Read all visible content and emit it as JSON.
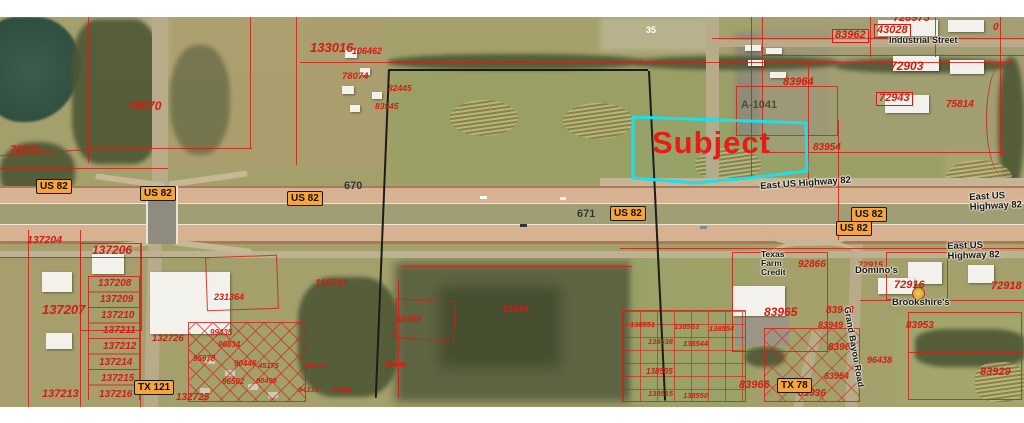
{
  "map": {
    "subject": {
      "label": "Subject"
    },
    "colors": {
      "parcel_line": "#cf2116",
      "parcel_text": "#d21d12",
      "subject_outline": "#1ae0ea",
      "subject_text": "#ea1a14",
      "shield_fill": "#f7a43a",
      "field": "#a3a06b"
    },
    "labels": [
      {
        "kind": "subject",
        "text": "Subject",
        "x": 652,
        "y": 126,
        "fs": 31
      },
      {
        "kind": "parcel",
        "text": "78061",
        "x": 10,
        "y": 145,
        "fs": 11
      },
      {
        "kind": "parcel",
        "text": "78070",
        "x": 128,
        "y": 100,
        "fs": 12
      },
      {
        "kind": "parcel",
        "text": "133016",
        "x": 310,
        "y": 41,
        "fs": 13
      },
      {
        "kind": "parcel",
        "text": "106462",
        "x": 352,
        "y": 47,
        "fs": 9
      },
      {
        "kind": "parcel",
        "text": "78074",
        "x": 342,
        "y": 72,
        "fs": 9.5
      },
      {
        "kind": "parcel",
        "text": "82445",
        "x": 388,
        "y": 84,
        "fs": 8.5
      },
      {
        "kind": "parcel",
        "text": "83545",
        "x": 375,
        "y": 102,
        "fs": 8.5
      },
      {
        "kind": "parcel",
        "text": "728975",
        "x": 893,
        "y": 13,
        "fs": 11
      },
      {
        "kind": "parcel",
        "text": "0",
        "x": 993,
        "y": 23,
        "fs": 10
      },
      {
        "kind": "parcel",
        "text": "83962",
        "x": 832,
        "y": 29,
        "fs": 11,
        "box": true
      },
      {
        "kind": "parcel",
        "text": "43028",
        "x": 874,
        "y": 24,
        "fs": 11,
        "box": true
      },
      {
        "kind": "parcel",
        "text": "72903",
        "x": 890,
        "y": 60,
        "fs": 12
      },
      {
        "kind": "parcel",
        "text": "83964",
        "x": 783,
        "y": 77,
        "fs": 11
      },
      {
        "kind": "parcel",
        "text": "72943",
        "x": 876,
        "y": 92,
        "fs": 11,
        "box": true
      },
      {
        "kind": "parcel",
        "text": "75814",
        "x": 946,
        "y": 100,
        "fs": 10
      },
      {
        "kind": "parcel",
        "text": "83954",
        "x": 813,
        "y": 143,
        "fs": 10
      },
      {
        "kind": "abs",
        "text": "A-1041",
        "x": 741,
        "y": 100,
        "fs": 11
      },
      {
        "kind": "white",
        "text": "35",
        "x": 646,
        "y": 26,
        "fs": 9
      },
      {
        "kind": "parcel",
        "text": "137204",
        "x": 27,
        "y": 235,
        "fs": 10.5
      },
      {
        "kind": "parcel",
        "text": "137206",
        "x": 92,
        "y": 244,
        "fs": 12
      },
      {
        "kind": "parcel",
        "text": "137207",
        "x": 42,
        "y": 303,
        "fs": 13
      },
      {
        "kind": "parcel",
        "text": "137208",
        "x": 98,
        "y": 279,
        "fs": 10
      },
      {
        "kind": "parcel",
        "text": "137209",
        "x": 100,
        "y": 295,
        "fs": 10
      },
      {
        "kind": "parcel",
        "text": "137210",
        "x": 101,
        "y": 311,
        "fs": 10
      },
      {
        "kind": "parcel",
        "text": "137211",
        "x": 103,
        "y": 326,
        "fs": 10
      },
      {
        "kind": "parcel",
        "text": "137212",
        "x": 103,
        "y": 342,
        "fs": 10
      },
      {
        "kind": "parcel",
        "text": "137214",
        "x": 99,
        "y": 358,
        "fs": 10
      },
      {
        "kind": "parcel",
        "text": "137215",
        "x": 101,
        "y": 374,
        "fs": 10
      },
      {
        "kind": "parcel",
        "text": "137216",
        "x": 99,
        "y": 390,
        "fs": 10
      },
      {
        "kind": "parcel",
        "text": "137213",
        "x": 42,
        "y": 389,
        "fs": 11
      },
      {
        "kind": "parcel",
        "text": "119761",
        "x": 315,
        "y": 279,
        "fs": 10
      },
      {
        "kind": "parcel",
        "text": "231364",
        "x": 214,
        "y": 293,
        "fs": 9
      },
      {
        "kind": "parcel",
        "text": "132726",
        "x": 152,
        "y": 334,
        "fs": 9.5
      },
      {
        "kind": "parcel",
        "text": "99435",
        "x": 210,
        "y": 329,
        "fs": 8
      },
      {
        "kind": "parcel",
        "text": "96834",
        "x": 218,
        "y": 341,
        "fs": 8
      },
      {
        "kind": "parcel",
        "text": "95978",
        "x": 193,
        "y": 355,
        "fs": 8
      },
      {
        "kind": "parcel",
        "text": "90446",
        "x": 234,
        "y": 360,
        "fs": 8
      },
      {
        "kind": "parcel",
        "text": "45175",
        "x": 258,
        "y": 362,
        "fs": 7.5
      },
      {
        "kind": "parcel",
        "text": "90374",
        "x": 305,
        "y": 362,
        "fs": 7.5
      },
      {
        "kind": "parcel",
        "text": "90448",
        "x": 385,
        "y": 361,
        "fs": 7.5
      },
      {
        "kind": "parcel",
        "text": "96502",
        "x": 222,
        "y": 378,
        "fs": 8
      },
      {
        "kind": "parcel",
        "text": "90495",
        "x": 256,
        "y": 377,
        "fs": 7.5
      },
      {
        "kind": "parcel",
        "text": "94139",
        "x": 298,
        "y": 386,
        "fs": 7.5
      },
      {
        "kind": "parcel",
        "text": "91044",
        "x": 331,
        "y": 386,
        "fs": 7.5
      },
      {
        "kind": "parcel",
        "text": "132725",
        "x": 176,
        "y": 393,
        "fs": 10
      },
      {
        "kind": "parcel",
        "text": "82489",
        "x": 396,
        "y": 315,
        "fs": 9
      },
      {
        "kind": "parcel",
        "text": "62434",
        "x": 503,
        "y": 305,
        "fs": 9
      },
      {
        "kind": "parcel",
        "text": "92866",
        "x": 798,
        "y": 260,
        "fs": 10
      },
      {
        "kind": "parcel",
        "text": "72915",
        "x": 858,
        "y": 261,
        "fs": 9
      },
      {
        "kind": "parcel",
        "text": "72916",
        "x": 894,
        "y": 280,
        "fs": 11
      },
      {
        "kind": "parcel",
        "text": "72918",
        "x": 991,
        "y": 281,
        "fs": 11
      },
      {
        "kind": "parcel",
        "text": "83965",
        "x": 764,
        "y": 306,
        "fs": 12
      },
      {
        "kind": "parcel",
        "text": "83943",
        "x": 826,
        "y": 306,
        "fs": 10
      },
      {
        "kind": "parcel",
        "text": "83949",
        "x": 818,
        "y": 321,
        "fs": 9
      },
      {
        "kind": "parcel",
        "text": "83953",
        "x": 906,
        "y": 321,
        "fs": 10
      },
      {
        "kind": "parcel",
        "text": "83961",
        "x": 828,
        "y": 343,
        "fs": 10
      },
      {
        "kind": "parcel",
        "text": "96438",
        "x": 867,
        "y": 356,
        "fs": 9
      },
      {
        "kind": "parcel",
        "text": "83954",
        "x": 824,
        "y": 372,
        "fs": 9
      },
      {
        "kind": "parcel",
        "text": "83966",
        "x": 739,
        "y": 380,
        "fs": 11
      },
      {
        "kind": "parcel",
        "text": "83936",
        "x": 798,
        "y": 389,
        "fs": 10
      },
      {
        "kind": "parcel",
        "text": "83929",
        "x": 980,
        "y": 367,
        "fs": 11
      },
      {
        "kind": "parcel",
        "text": "138551",
        "x": 630,
        "y": 321,
        "fs": 7.5
      },
      {
        "kind": "parcel",
        "text": "138553",
        "x": 674,
        "y": 323,
        "fs": 7.5
      },
      {
        "kind": "parcel",
        "text": "138554",
        "x": 709,
        "y": 325,
        "fs": 7.5
      },
      {
        "kind": "parcel",
        "text": "138538",
        "x": 648,
        "y": 338,
        "fs": 7.5
      },
      {
        "kind": "parcel",
        "text": "138544",
        "x": 683,
        "y": 340,
        "fs": 7.5
      },
      {
        "kind": "parcel",
        "text": "138535",
        "x": 646,
        "y": 368,
        "fs": 8
      },
      {
        "kind": "parcel",
        "text": "138515",
        "x": 648,
        "y": 390,
        "fs": 7.5
      },
      {
        "kind": "parcel",
        "text": "138550",
        "x": 683,
        "y": 392,
        "fs": 7.5
      },
      {
        "kind": "exit",
        "text": "670",
        "x": 344,
        "y": 181,
        "fs": 11
      },
      {
        "kind": "exit",
        "text": "671",
        "x": 577,
        "y": 209,
        "fs": 11
      },
      {
        "kind": "street",
        "text": "East US Highway 82",
        "x": 760,
        "y": 182,
        "fs": 9.5,
        "rot": -4
      },
      {
        "kind": "street",
        "text": "East US Highway 82",
        "x": 969,
        "y": 193,
        "fs": 9.5,
        "rot": -3
      },
      {
        "kind": "street",
        "text": "East US Highway 82",
        "x": 947,
        "y": 242,
        "fs": 9.5,
        "rot": -2
      },
      {
        "kind": "street",
        "text": "Industrial Street",
        "x": 889,
        "y": 36,
        "fs": 9
      },
      {
        "kind": "street",
        "text": "Texas\nFarm\nCredit",
        "x": 761,
        "y": 250,
        "fs": 8.5
      },
      {
        "kind": "street",
        "text": "Domino's",
        "x": 855,
        "y": 266,
        "fs": 9.5
      },
      {
        "kind": "street",
        "text": "Brookshire's",
        "x": 892,
        "y": 298,
        "fs": 9.5
      },
      {
        "kind": "street",
        "text": "Grand Bayou Road",
        "x": 851,
        "y": 306,
        "fs": 9,
        "rot": 80
      }
    ],
    "shields": [
      {
        "text": "US 82",
        "x": 36,
        "y": 179
      },
      {
        "text": "US 82",
        "x": 140,
        "y": 186
      },
      {
        "text": "US 82",
        "x": 287,
        "y": 191
      },
      {
        "text": "US 82",
        "x": 610,
        "y": 206
      },
      {
        "text": "US 82",
        "x": 851,
        "y": 207
      },
      {
        "text": "US 82",
        "x": 836,
        "y": 221
      },
      {
        "text": "TX 121",
        "x": 134,
        "y": 380
      },
      {
        "text": "TX 78",
        "x": 777,
        "y": 378
      }
    ]
  }
}
